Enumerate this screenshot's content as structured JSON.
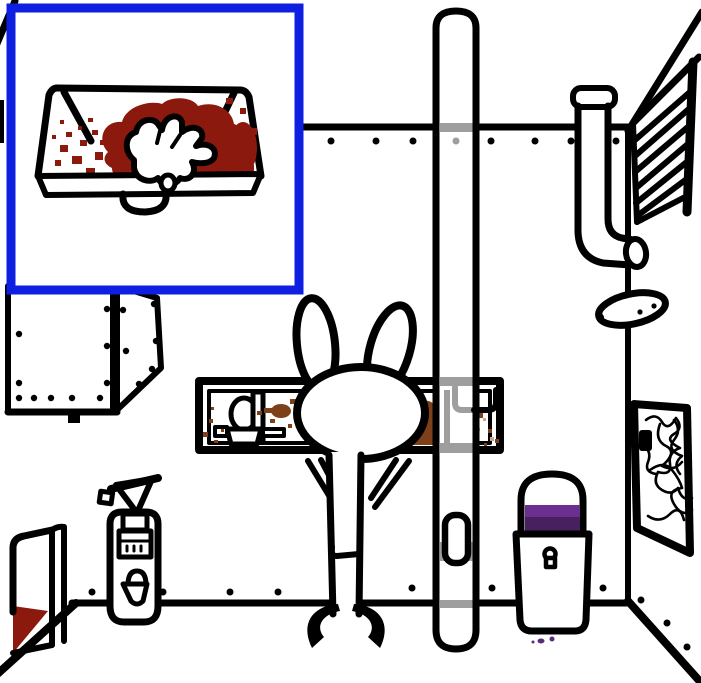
{
  "meta": {
    "scene_type": "point-and-click-game-room",
    "width": 701,
    "height": 683
  },
  "objects": [
    "inset-closeup-bloody-sink",
    "bloody-glove",
    "wall-hatch",
    "dustpan-with-blood",
    "fire-extinguisher",
    "window",
    "fountain-behind-window",
    "rabbit-character",
    "center-pipe",
    "pipe-latch",
    "ceiling-pipe-elbow",
    "pickle",
    "wall-vent",
    "scribble-picture",
    "trash-can-purple-liquid"
  ],
  "colors": {
    "outline": "#000000",
    "wall_white": "#ffffff",
    "inset_border_blue": "#0e1fe1",
    "blood_red": "#8c190e",
    "stain_brown": "#7d4018",
    "stain_brown_light": "#c8a694",
    "showthrough_gray": "#9e9e9e",
    "purple_light": "#6b2e91",
    "purple_dark": "#47215f",
    "purple_drip": "#5a2b7d"
  }
}
